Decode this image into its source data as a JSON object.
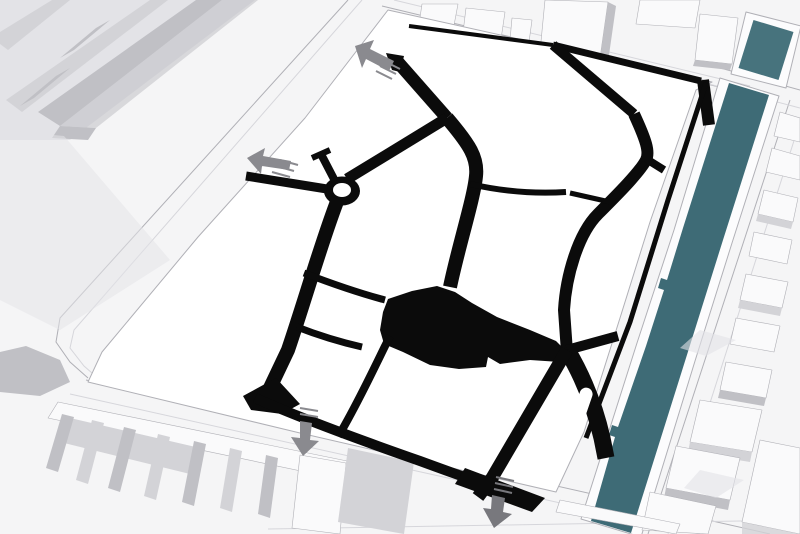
{
  "figure": {
    "kind": "axonometric-site-massing-diagram",
    "description": "Monochrome 3D massing model of an urban district. The central site is a flat white plane carrying a solid black figure-ground street network with a roundabout and a large central black square. Two dark teal canal basins border the site on the east, white context buildings surround it, and grey arrows mark access points on the north-west, west and south edges.",
    "site": {
      "surface": "flat white plane",
      "network_style": "solid black streets (figure-ground)"
    },
    "landmarks": {
      "roundabout": "traffic circle with white centre on the north-west street",
      "central_square": "large irregular black mass at the centre of the network",
      "median_island": "white rounded island inside the south-east street",
      "dead_end": "short T-capped spur beside the roundabout"
    },
    "canals": [
      {
        "id": "canal-north",
        "note": "short basin in the top-right corner"
      },
      {
        "id": "canal-main",
        "note": "long basin running along the full east edge, with stepped quay notches"
      }
    ],
    "arrows": [
      {
        "id": "arrow-northwest",
        "direction": "up-left",
        "edge": "north-west site corner"
      },
      {
        "id": "arrow-west",
        "direction": "left",
        "edge": "west site edge"
      },
      {
        "id": "arrow-south-left",
        "direction": "down",
        "edge": "south edge, left"
      },
      {
        "id": "arrow-south-right",
        "direction": "down",
        "edge": "south edge, right"
      }
    ],
    "context": [
      "terraced slab block with parallel fins, north-west corner",
      "row of detached blocks north of the site",
      "perimeter blocks east of the canal",
      "slab housing row with fins along the south-west edge"
    ]
  },
  "colors": {
    "background": "#f5f5f6",
    "site": "#ffffff",
    "network": "#0b0b0b",
    "canal": "#3e6b76",
    "canal_light": "#47737d",
    "quay": "#fcfcfd",
    "edge": "#b0b0b6",
    "edge_soft": "#d6d6db",
    "roof": "#fafafb",
    "face": "#d3d3d7",
    "face_dark": "#c0c0c5",
    "shade": "#e3e3e7",
    "arrow": "#8a8a8f",
    "arrow_dark": "#78787d"
  }
}
